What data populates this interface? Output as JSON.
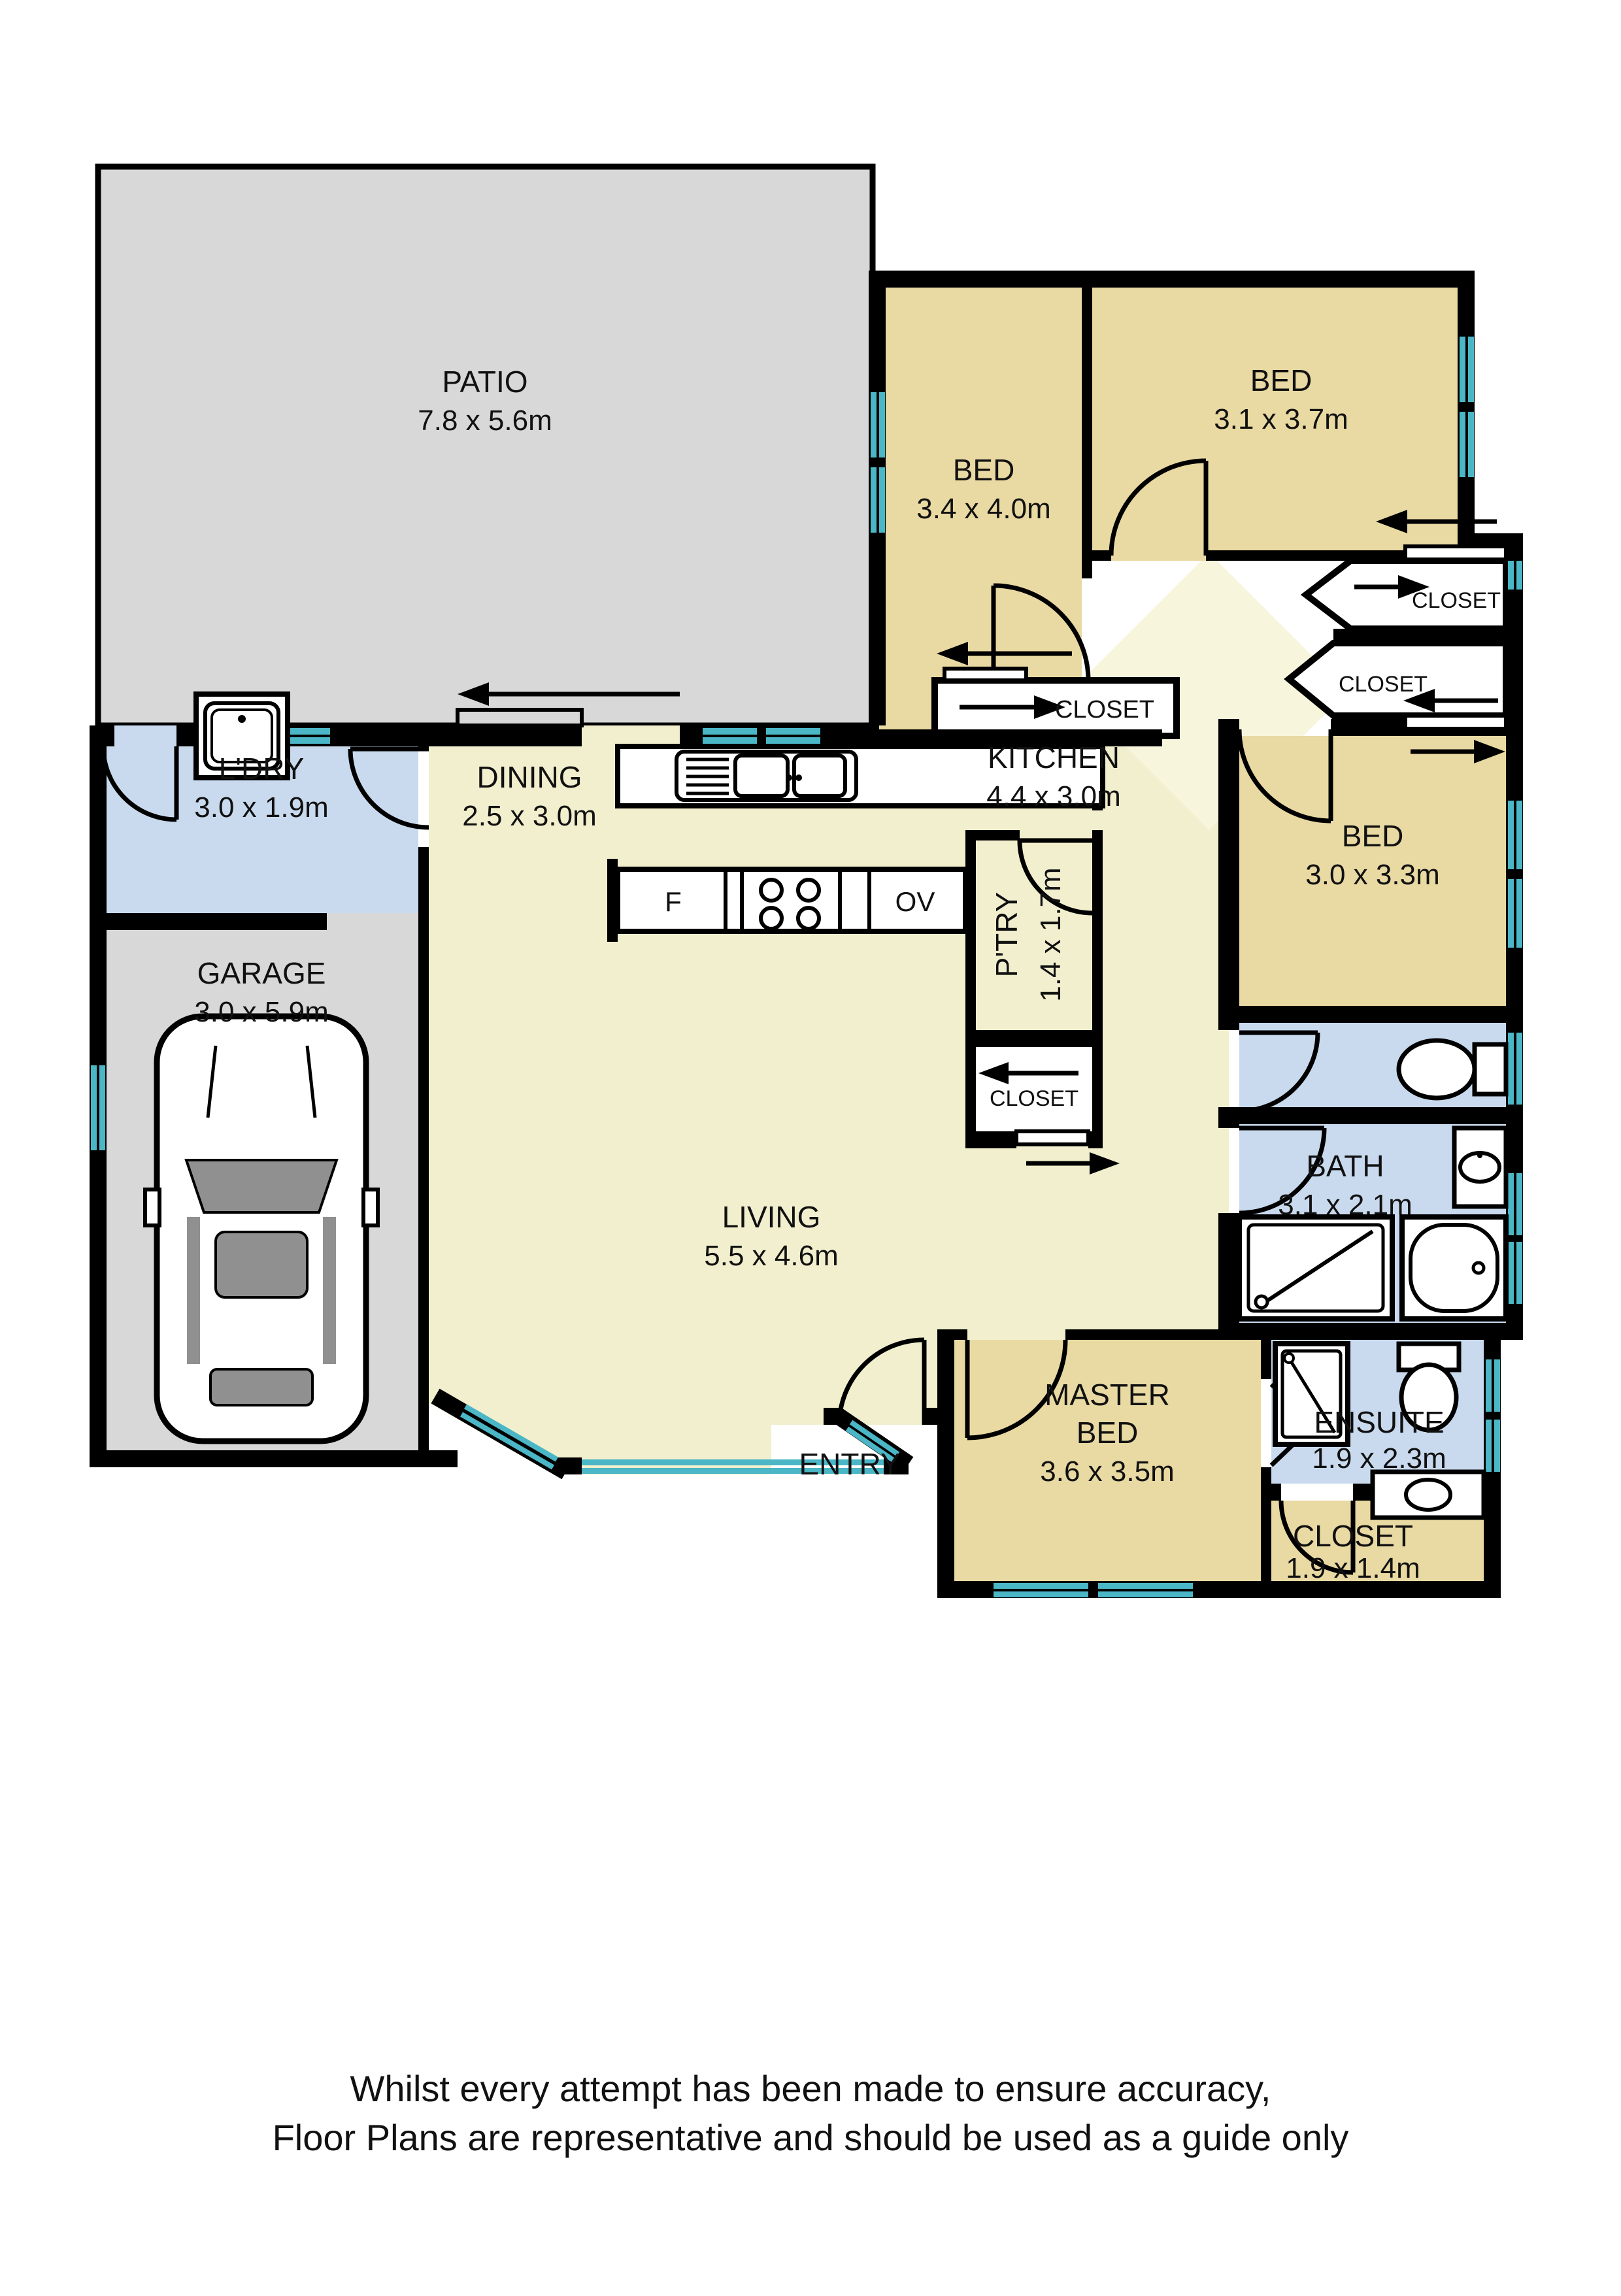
{
  "plan_title": "Residential floor plan",
  "rooms": {
    "patio": {
      "name": "PATIO",
      "dims": "7.8 x 5.6m"
    },
    "bed1": {
      "name": "BED",
      "dims": "3.4 x 4.0m"
    },
    "bed2": {
      "name": "BED",
      "dims": "3.1 x 3.7m"
    },
    "bed3": {
      "name": "BED",
      "dims": "3.0 x 3.3m"
    },
    "master": {
      "name1": "MASTER",
      "name2": "BED",
      "dims": "3.6 x 3.5m"
    },
    "laundry": {
      "name": "L'DRY",
      "dims": "3.0 x 1.9m"
    },
    "garage": {
      "name": "GARAGE",
      "dims": "3.0 x 5.9m"
    },
    "dining": {
      "name": "DINING",
      "dims": "2.5 x 3.0m"
    },
    "kitchen": {
      "name": "KITCHEN",
      "dims": "4.4 x 3.0m"
    },
    "pantry": {
      "name": "P'TRY",
      "dims": "1.4 x 1.7m"
    },
    "living": {
      "name": "LIVING",
      "dims": "5.5 x 4.6m"
    },
    "bath": {
      "name": "BATH",
      "dims": "3.1 x 2.1m"
    },
    "ensuite": {
      "name": "ENSUITE",
      "dims": "1.9 x 2.3m"
    },
    "masterCloset": {
      "name": "CLOSET",
      "dims": "1.9 x 1.4m"
    },
    "closetBed1": {
      "name": "CLOSET"
    },
    "closetBed2": {
      "name": "CLOSET"
    },
    "closetBed3": {
      "name": "CLOSET"
    },
    "closetHall": {
      "name": "CLOSET"
    },
    "entry": {
      "name": "ENTRY"
    }
  },
  "appliances": {
    "fridge": "F",
    "oven": "OV"
  },
  "disclaimer": {
    "line1": "Whilst every attempt has been made to ensure accuracy,",
    "line2": "Floor Plans are representative and should be used as a guide only"
  },
  "colors": {
    "outdoor": "#d8d8d8",
    "bedroom": "#e9d9a2",
    "wet": "#c9daee",
    "live": "#f1efcd",
    "hall_light": "#f8f5dd",
    "window": "#4ab6c6",
    "wall": "#000000",
    "car_glass": "#909090"
  }
}
